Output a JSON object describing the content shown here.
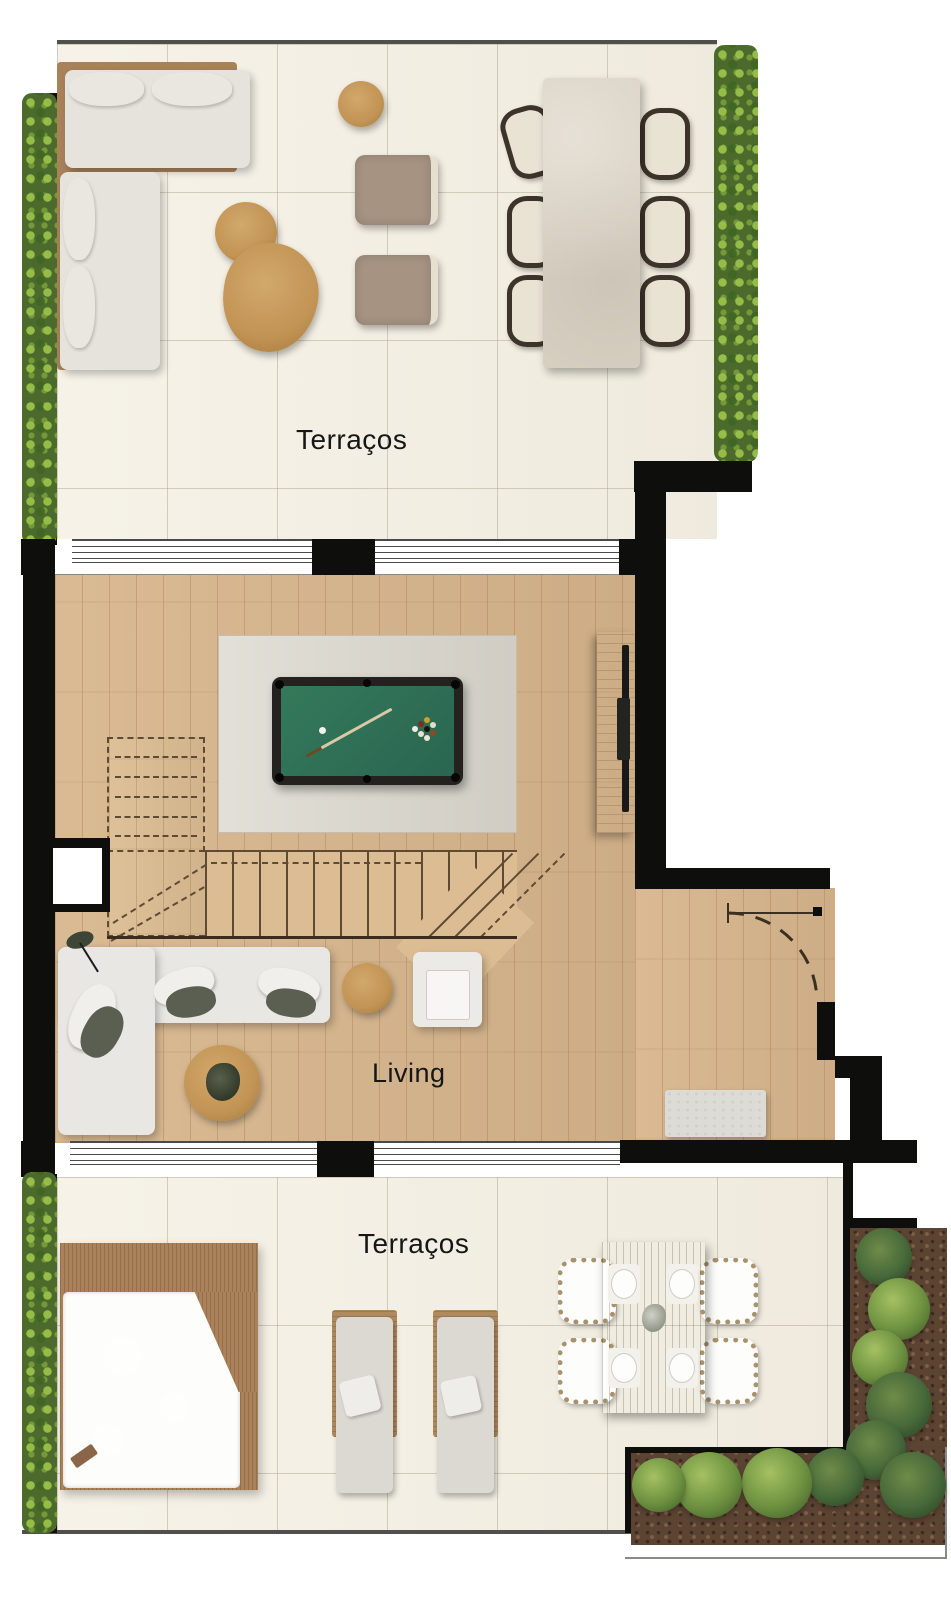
{
  "labels": {
    "terrace_top": "Terraços",
    "living": "Living",
    "terrace_bottom": "Terraços"
  },
  "palette": {
    "wall": "#0e0e0c",
    "terrace_tile": "#f3eee1",
    "wood_floor": "#d7b68d",
    "rug": "#d9d5cb",
    "pool_table_felt": "#2f7256",
    "pool_table_frame": "#23221e",
    "jacuzzi_water": "#b7cdca",
    "deck_wood": "#ab8159",
    "hedge_green": "#5e7c33",
    "sofa_fabric": "#e9e7e3",
    "accent_wood": "#c89a5e",
    "dining_table_dark": "#6f4b2e",
    "stone_table": "#d8d0c1"
  },
  "furniture": {
    "terrace_top": [
      "corner-sofa",
      "coffee-table-duo",
      "round-side-table",
      "armchair",
      "armchair",
      "stone-dining-table",
      "dining-chair-1",
      "dining-chair-2",
      "dining-chair-3",
      "dining-chair-4",
      "dining-chair-5",
      "dining-chair-6"
    ],
    "living": [
      "pool-table",
      "area-rug",
      "staircase",
      "tv-console",
      "corner-sofa",
      "round-coffee-table",
      "round-side-table",
      "armchair",
      "entry-bench",
      "entry-door"
    ],
    "terrace_bottom": [
      "jacuzzi",
      "wood-deck",
      "sun-lounger-1",
      "sun-lounger-2",
      "outdoor-dining-table",
      "dining-chair-1",
      "dining-chair-2",
      "dining-chair-3",
      "dining-chair-4",
      "corner-planter"
    ]
  }
}
